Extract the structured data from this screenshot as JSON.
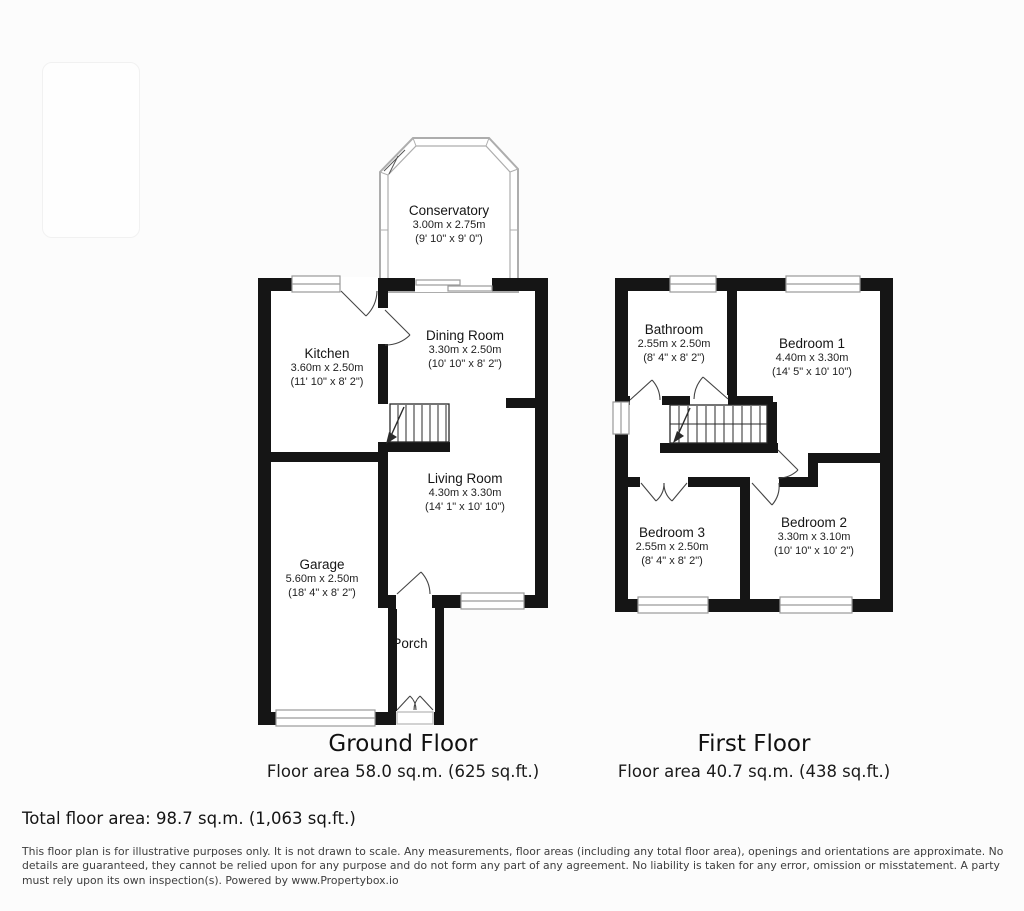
{
  "colors": {
    "wall": "#151515",
    "glass_frame": "#adadad",
    "window_frame": "#9a9a9a",
    "background": "#fcfcfc"
  },
  "floors": [
    {
      "id": "ground",
      "title": "Ground Floor",
      "area": "Floor area 58.0 sq.m. (625 sq.ft.)",
      "rooms": [
        {
          "name": "Conservatory",
          "metric": "3.00m x 2.75m",
          "imperial": "(9' 10\" x 9' 0\")"
        },
        {
          "name": "Kitchen",
          "metric": "3.60m x 2.50m",
          "imperial": "(11' 10\" x 8' 2\")"
        },
        {
          "name": "Dining Room",
          "metric": "3.30m x 2.50m",
          "imperial": "(10' 10\" x 8' 2\")"
        },
        {
          "name": "Living Room",
          "metric": "4.30m x 3.30m",
          "imperial": "(14' 1\" x 10' 10\")"
        },
        {
          "name": "Garage",
          "metric": "5.60m x 2.50m",
          "imperial": "(18' 4\" x 8' 2\")"
        },
        {
          "name": "Porch",
          "metric": "",
          "imperial": ""
        }
      ]
    },
    {
      "id": "first",
      "title": "First Floor",
      "area": "Floor area 40.7 sq.m. (438 sq.ft.)",
      "rooms": [
        {
          "name": "Bathroom",
          "metric": "2.55m x 2.50m",
          "imperial": "(8' 4\" x 8' 2\")"
        },
        {
          "name": "Bedroom 1",
          "metric": "4.40m x 3.30m",
          "imperial": "(14' 5\" x 10' 10\")"
        },
        {
          "name": "Bedroom 3",
          "metric": "2.55m x 2.50m",
          "imperial": "(8' 4\" x 8' 2\")"
        },
        {
          "name": "Bedroom 2",
          "metric": "3.30m x 3.10m",
          "imperial": "(10' 10\" x 10' 2\")"
        }
      ]
    }
  ],
  "footer": {
    "total": "Total floor area: 98.7 sq.m. (1,063 sq.ft.)",
    "disclaimer": "This floor plan is for illustrative purposes only. It is not drawn to scale. Any measurements, floor areas (including any total floor area), openings and orientations are approximate. No details are guaranteed, they cannot be relied upon for any purpose and do not form any part of any agreement. No liability is taken for any error, omission or misstatement. A party must rely upon its own inspection(s). Powered by www.Propertybox.io"
  }
}
